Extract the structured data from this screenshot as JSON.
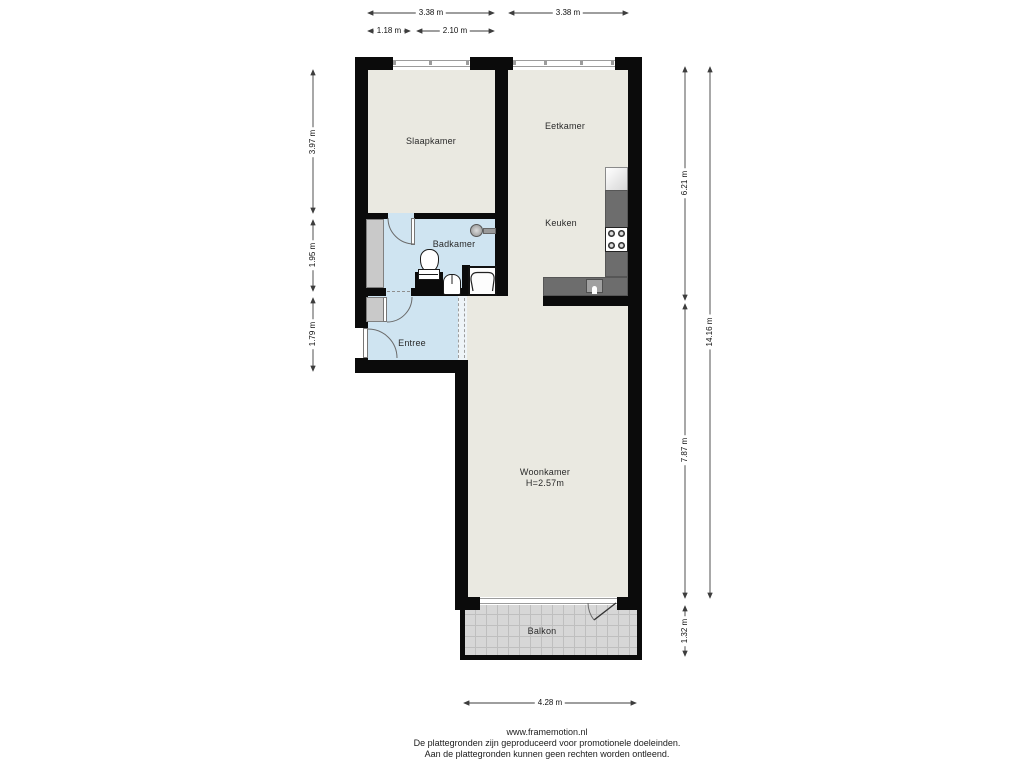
{
  "plan": {
    "type": "apartment-floorplan",
    "rooms": {
      "slaapkamer": "Slaapkamer",
      "eetkamer": "Eetkamer",
      "keuken": "Keuken",
      "badkamer": "Badkamer",
      "entree": "Entree",
      "woonkamer": "Woonkamer",
      "woonkamer_height": "H=2.57m",
      "balkon": "Balkon"
    },
    "fixtures": [
      "fridge",
      "kitchen-counter",
      "stove",
      "kitchen-sink",
      "toilet",
      "washbasin",
      "shower-tray",
      "shower-head",
      "closet",
      "wardrobe-strip",
      "balcony-tiles"
    ],
    "colors": {
      "wall": "#0b0b0b",
      "room_floor": "#eae9e1",
      "wet_room_floor": "#cfe4f1",
      "closet_fill": "#c9c9c9",
      "counter_fill": "#6d6d6d",
      "balcony_tile": "#d7d7d7",
      "background": "#ffffff"
    }
  },
  "dimensions": {
    "top1": "3.38 m",
    "top2": "3.38 m",
    "top3": "1.18 m",
    "top4": "2.10 m",
    "left1": "3.97 m",
    "left2": "1.95 m",
    "left3": "1.79 m",
    "right1": "6.21 m",
    "right2": "7.87 m",
    "right3": "1.32 m",
    "right_total": "14.16 m",
    "bottom1": "4.28 m"
  },
  "footer": {
    "url": "www.framemotion.nl",
    "line1": "De plattegronden zijn geproduceerd voor promotionele doeleinden.",
    "line2": "Aan de plattegronden kunnen geen rechten worden ontleend."
  }
}
